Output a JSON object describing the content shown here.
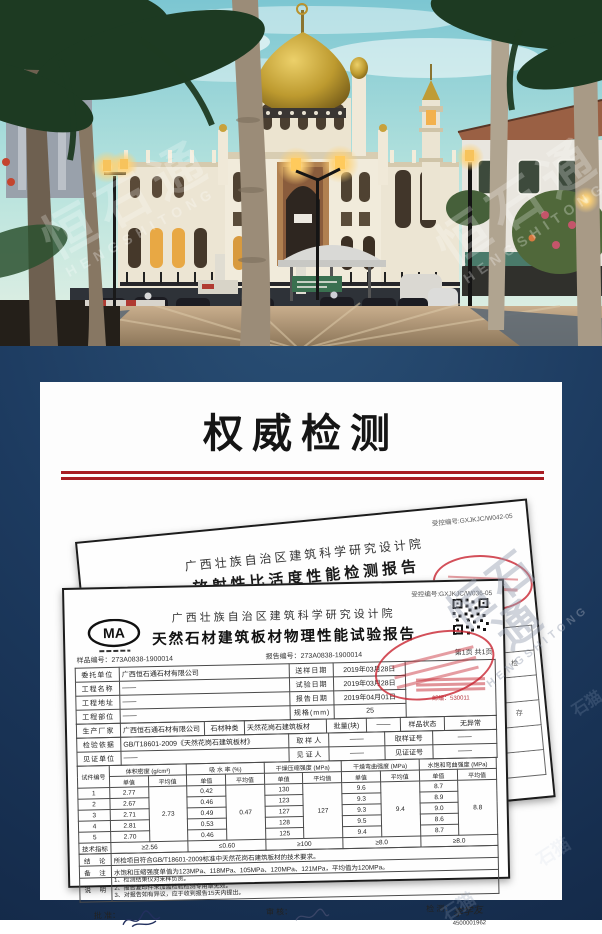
{
  "hero": {
    "watermark_cn": "恒石通",
    "watermark_en": "HENGSHITONG"
  },
  "section": {
    "title": "权威检测",
    "accent_red": "#a81d23"
  },
  "watermark_misc": "石猫",
  "back_doc": {
    "control_no": "受控编号:GXJKJC/W042-05",
    "org": "广西壮族自治区建筑科学研究设计院",
    "title": "放射性比活度性能检测报告",
    "report_no": "报告编号：273A0842-Y010021",
    "page_no": "第2页 共2页",
    "date": "2018年11月08日",
    "side_cells": [
      "检",
      "存"
    ]
  },
  "front_doc": {
    "control_no": "受控编号:GXJKJC/W036-05",
    "cma_label": "MA",
    "org": "广西壮族自治区建筑科学研究设计院",
    "title": "天然石材建筑板材物理性能试验报告",
    "sample_no": "样品编号：273A0838-1900014",
    "report_no": "报告编号：273A0838-1900014",
    "page_no": "第1页 共1页",
    "info": {
      "client_label": "委托单位",
      "client": "广西恒石通石材有限公司",
      "send_date_label": "送样日期",
      "send_date": "2019年03月28日",
      "project_label": "工程名称",
      "project": "——",
      "test_date_label": "试验日期",
      "test_date": "2019年03月28日",
      "addr_label": "工程地址",
      "addr": "——",
      "report_date_label": "报告日期",
      "report_date": "2019年04月01日",
      "part_label": "工程部位",
      "part": "——",
      "spec_label": "规格(mm)",
      "spec": "25",
      "maker_label": "生产厂家",
      "maker": "广西恒石通石材有限公司",
      "stone_label": "石材种类",
      "stone": "天然花岗石建筑板材",
      "batch_label": "批量(块)",
      "batch": "——",
      "state_label": "样品状态",
      "state": "无异常",
      "basis_label": "检验依据",
      "basis": "GB/T18601-2009《天然花岗石建筑板材》",
      "sampler_label": "取 样 人",
      "sampler": "——",
      "sampler_no_label": "取样证号",
      "sampler_no": "——",
      "witness_unit_label": "见证单位",
      "witness_unit": "——",
      "witness_label": "见 证 人",
      "witness": "——",
      "witness_no_label": "见证证号",
      "witness_no": "——"
    },
    "stamp_postal": "邮编：530011",
    "results": {
      "col_specimen": "试件编号",
      "headers": [
        "体积密度 (g/cm³)",
        "吸 水 率 (%)",
        "干燥压缩强度 (MPa)",
        "干燥弯曲强度 (MPa)",
        "水饱和弯曲强度 (MPa)"
      ],
      "sub_single": "单值",
      "sub_avg": "平均值",
      "specimens": [
        {
          "no": "1",
          "density": "2.77",
          "absorption": "0.42",
          "dry_comp": "130",
          "dry_flex": "9.6",
          "wet_flex": "8.7"
        },
        {
          "no": "2",
          "density": "2.67",
          "absorption": "0.46",
          "dry_comp": "123",
          "dry_flex": "9.3",
          "wet_flex": "8.9"
        },
        {
          "no": "3",
          "density": "2.71",
          "absorption": "0.49",
          "dry_comp": "127",
          "dry_flex": "9.3",
          "wet_flex": "9.0"
        },
        {
          "no": "4",
          "density": "2.81",
          "absorption": "0.53",
          "dry_comp": "128",
          "dry_flex": "9.5",
          "wet_flex": "8.6"
        },
        {
          "no": "5",
          "density": "2.70",
          "absorption": "0.46",
          "dry_comp": "125",
          "dry_flex": "9.4",
          "wet_flex": "8.7"
        }
      ],
      "avg": {
        "density": "2.73",
        "absorption": "0.47",
        "dry_comp": "127",
        "dry_flex": "9.4",
        "wet_flex": "8.8"
      },
      "tech": {
        "label": "技术指标",
        "density": "≥2.56",
        "absorption": "≤0.60",
        "dry_comp": "≥100",
        "dry_flex": "≥8.0",
        "wet_flex": "≥8.0"
      }
    },
    "conclusion": {
      "label": "结　论",
      "text": "所检项目符合GB/T18601-2009标准中天然花岗石建筑板材的技术要求。"
    },
    "remark": {
      "label": "备　注",
      "text": "水饱和压缩强度单值为123MPa、118MPa、105MPa、120MPa、121MPa，平均值为120MPa。"
    },
    "notes": {
      "label": "说　明",
      "lines": [
        "1、检测结果仅对来样负责。",
        "2、报告复印件未加盖检验检测专用章无效。",
        "3、对报告如有异议，应于收到报告15天内提出。"
      ]
    },
    "signatures": {
      "approve_label": "批 准：",
      "review_label": "审 核：",
      "test_label": "检 测：",
      "tester": "李学友",
      "tester_no": "4500001962"
    }
  }
}
